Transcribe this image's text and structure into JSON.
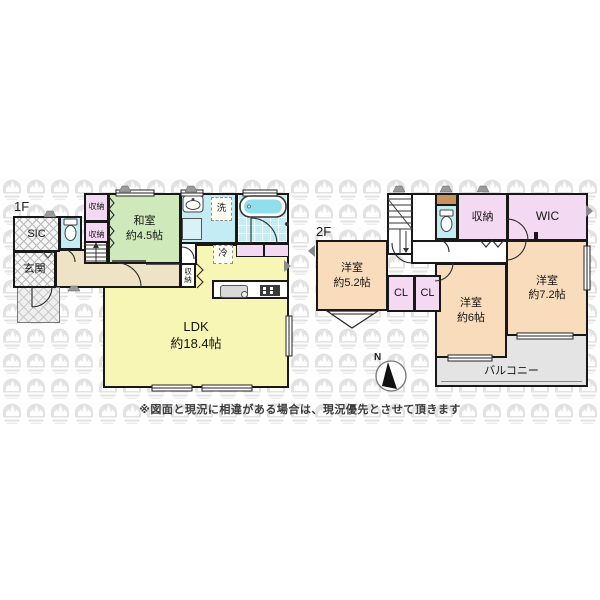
{
  "f1": {
    "label": "1F",
    "sic": "SIC",
    "genkan": "玄関",
    "closet_a": "収納",
    "closet_b": "収納",
    "closet_small": "収\n納",
    "washitsu_name": "和室",
    "washitsu_size": "約4.5帖",
    "laundry": "洗",
    "fridge": "冷",
    "ldk_name": "LDK",
    "ldk_size": "約18.4帖"
  },
  "f2": {
    "label": "2F",
    "closet": "収納",
    "wic": "WIC",
    "cl_a": "CL",
    "cl_b": "CL",
    "room52_name": "洋室",
    "room52_size": "約5.2帖",
    "room6_name": "洋室",
    "room6_size": "約6帖",
    "room72_name": "洋室",
    "room72_size": "約7.2帖",
    "balcony": "バルコニー"
  },
  "compass": {
    "north_label": "N"
  },
  "disclaimer": "※図面と現況に相違がある場合は、現況優先とさせて頂きます",
  "colors": {
    "tatami_green": "#cfe9ba",
    "ldk_yellow": "#f8f6b5",
    "western_room_peach": "#f8dcbb",
    "closet_lavender": "#f3d9f1",
    "wet_area_cyan": "#c3ecf4",
    "hall_beige": "#efe3c6",
    "balcony_gray": "#e4e4e4",
    "toilet_shelf_brown": "#c9935f",
    "wall_black": "#181818",
    "watermark_gray": "#e2e2e2"
  }
}
